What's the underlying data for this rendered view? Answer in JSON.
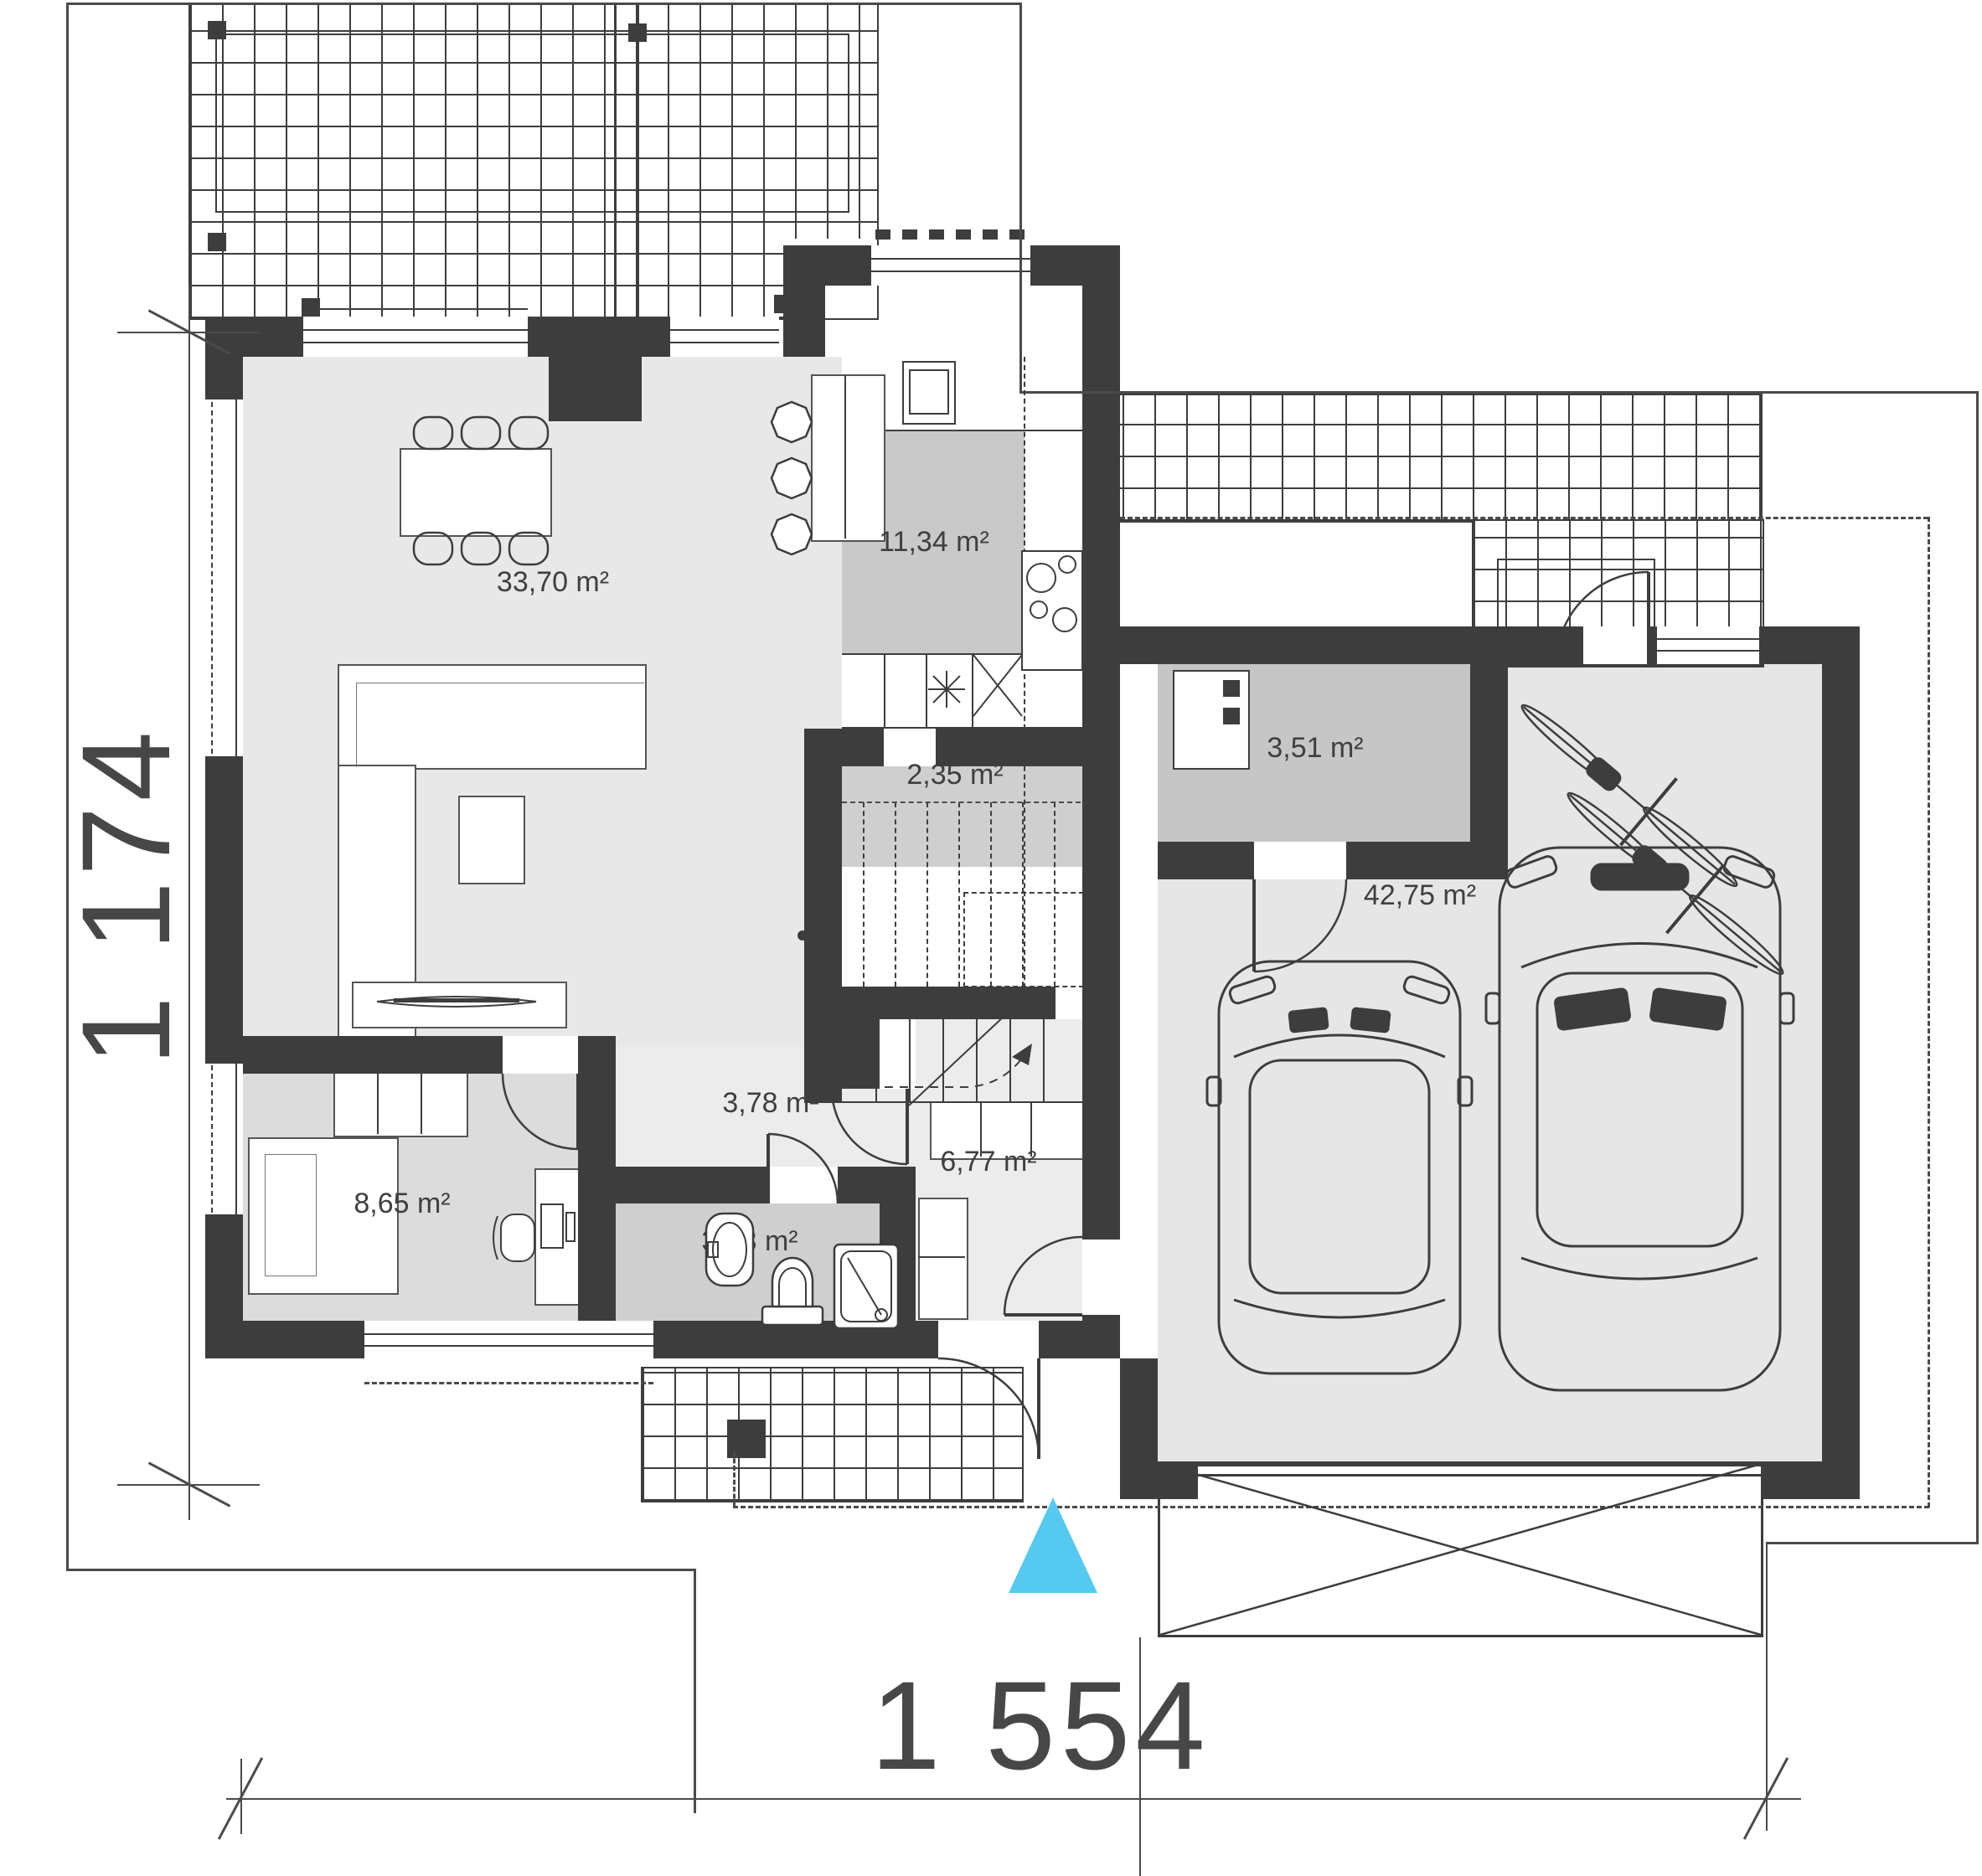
{
  "document": {
    "type": "architectural floor plan",
    "floor": "ground floor"
  },
  "dimensions": {
    "height_label": "1 174",
    "width_label": "1 554"
  },
  "rooms": [
    {
      "name": "living-dining-room",
      "area": "33,70 m²"
    },
    {
      "name": "kitchen",
      "area": "11,34 m²"
    },
    {
      "name": "pantry-under-stairs",
      "area": "2,35 m²"
    },
    {
      "name": "utility-room",
      "area": "3,51 m²"
    },
    {
      "name": "garage",
      "area": "42,75 m²"
    },
    {
      "name": "hall",
      "area": "3,78 m²"
    },
    {
      "name": "entrance-hall",
      "area": "6,77 m²"
    },
    {
      "name": "office",
      "area": "8,65 m²"
    },
    {
      "name": "bathroom",
      "area": "3,33 m²"
    }
  ],
  "colors": {
    "walls": "#3d3d3d",
    "entrance_marker": "#56c9f0",
    "kitchen_floor": "#c9c9c9",
    "living_floor": "#e8e8e8",
    "garage_floor": "#e6e6e6"
  },
  "icons": {
    "entrance_marker": "entrance-triangle"
  }
}
